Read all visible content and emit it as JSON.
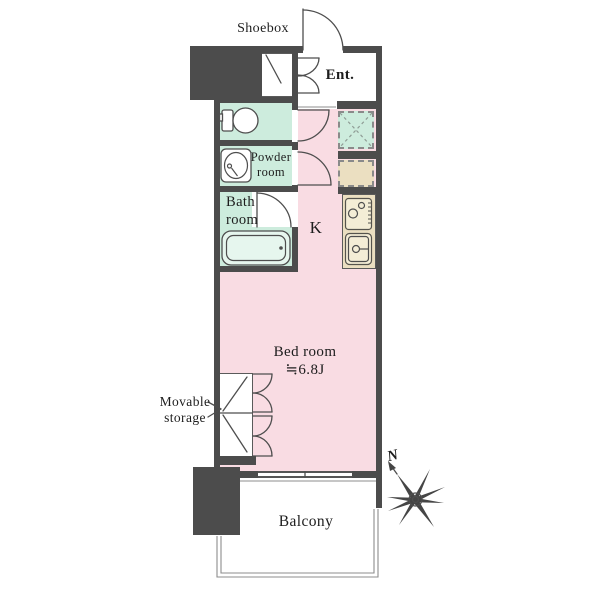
{
  "floorplan": {
    "rooms": {
      "entrance": {
        "label": "Ent."
      },
      "shoebox": {
        "label": "Shoebox"
      },
      "powder_room": {
        "label": "Powder room"
      },
      "bath_room": {
        "label": "Bath room"
      },
      "kitchen": {
        "label": "K"
      },
      "bed_room": {
        "label": "Bed room",
        "size": "≒6.8J"
      },
      "movable_storage": {
        "label": "Movable storage"
      },
      "balcony": {
        "label": "Balcony"
      }
    },
    "compass": {
      "north_label": "N"
    },
    "colors": {
      "wall": "#4c4c4c",
      "floor_pink": "#f9dce3",
      "floor_mint": "#cdecdd",
      "fixture_beige": "#ebdfc1",
      "outline": "#555555",
      "text": "#1d1d1d"
    }
  }
}
